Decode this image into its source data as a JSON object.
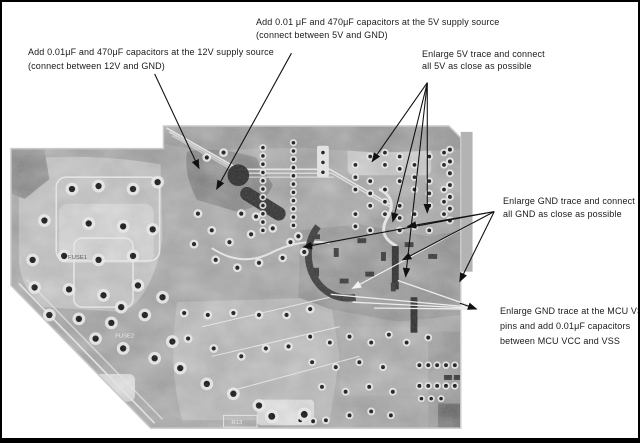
{
  "annotations": {
    "cap_12v": {
      "line1": "Add 0.01μF and 470μF capacitors at the 12V supply source",
      "line2": "(connect between 12V and GND)"
    },
    "cap_5v": {
      "line1": "Add 0.01 μF and 470μF capacitors at the 5V supply source",
      "line2": "(connect between 5V and GND)"
    },
    "trace_5v": {
      "line1": "Enlarge 5V trace and connect",
      "line2": "all 5V as close as possible"
    },
    "trace_gnd": {
      "line1": "Enlarge GND trace and connect",
      "line2": "all GND as close as possible"
    },
    "mcu_vss": {
      "line1": "Enlarge GND trace at the MCU VSS",
      "line2": "pins and add 0.01μF capacitors",
      "line3": "between MCU VCC and VSS"
    }
  },
  "pcb": {
    "silkscreen": {
      "fuse1": "FUSE1",
      "fuse2": "FUSE2",
      "r13": "R13"
    }
  },
  "colors": {
    "background": "#ffffff",
    "frame": "#000000",
    "annotation_text": "#1a1a1a",
    "arrow": "#111111",
    "board_base": "#9e9e9e"
  }
}
